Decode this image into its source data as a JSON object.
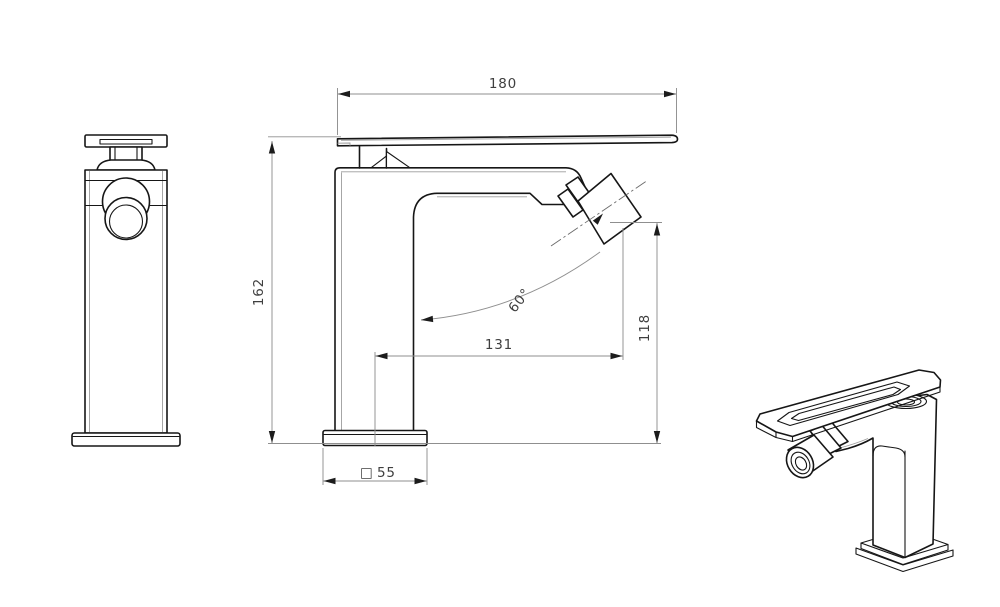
{
  "dimensions": {
    "handle_length": "180",
    "overall_height": "162",
    "outlet_height": "118",
    "spout_reach": "131",
    "spout_angle": "60°",
    "base_square_symbol": "□",
    "base_size": "55"
  },
  "style": {
    "object_line_color": "#161616",
    "dimension_line_color": "#8f8f8f",
    "dimension_text_color": "#3f3f3f",
    "background": "#ffffff"
  }
}
